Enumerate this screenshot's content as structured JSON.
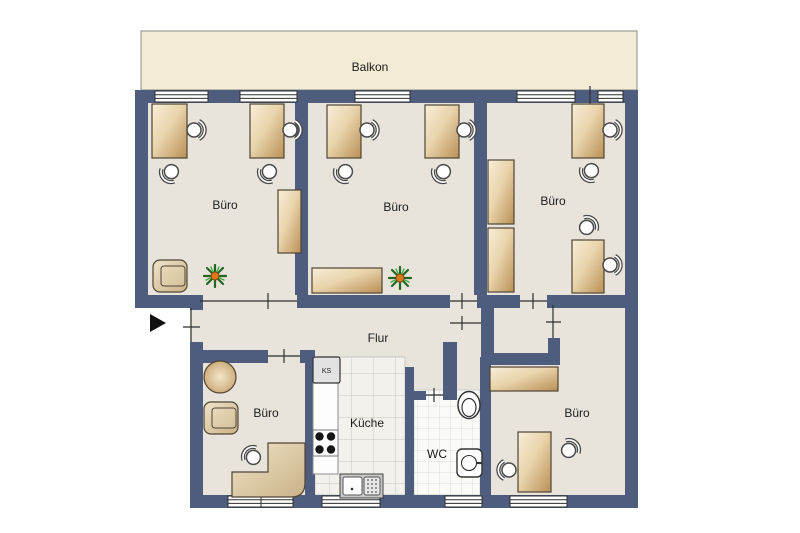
{
  "floor_plan": {
    "balcony": {
      "label": "Balkon"
    },
    "offices": [
      {
        "label": "Büro"
      },
      {
        "label": "Büro"
      },
      {
        "label": "Büro"
      },
      {
        "label": "Büro"
      },
      {
        "label": "Büro"
      }
    ],
    "hallway": {
      "label": "Flur"
    },
    "kitchen": {
      "label": "Küche",
      "fridge_label": "KS"
    },
    "wc": {
      "label": "WC"
    }
  },
  "colors": {
    "wall": "#4e5c7d",
    "floor": "#e8e4db",
    "balcony": "#f1ecd3",
    "outline": "#2f2f2f",
    "desk_light": "#f8eed8",
    "desk_dark": "#b98f55",
    "plant_green": "#226622",
    "plant_center": "#e0761c"
  }
}
